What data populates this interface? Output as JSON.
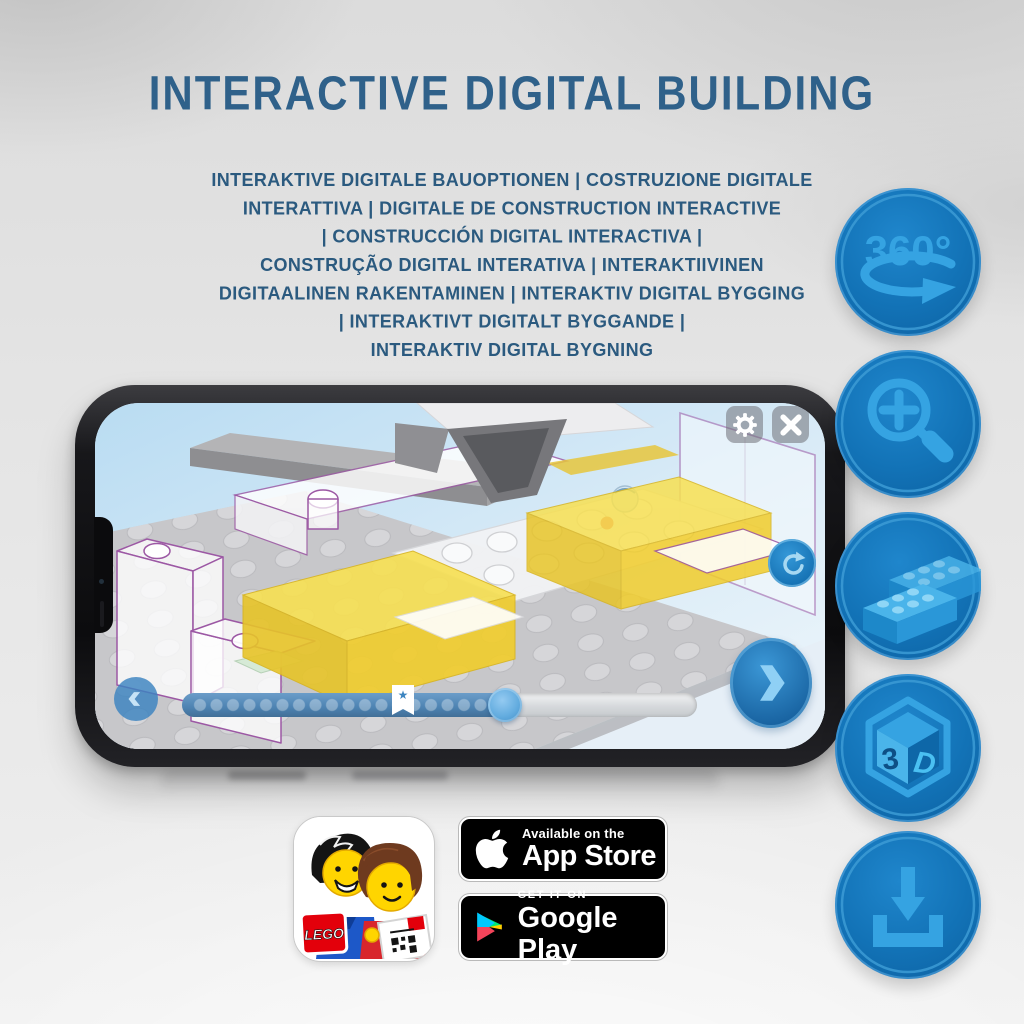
{
  "header": {
    "title": "INTERACTIVE DIGITAL BUILDING",
    "subtitle_lines": [
      "INTERAKTIVE DIGITALE BAUOPTIONEN | COSTRUZIONE DIGITALE",
      "INTERATTIVA | DIGITALE DE CONSTRUCTION INTERACTIVE",
      "| CONSTRUCCIÓN DIGITAL INTERACTIVA |",
      "CONSTRUÇÃO DIGITAL INTERATIVA | INTERAKTIIVINEN",
      "DIGITAALINEN RAKENTAMINEN | INTERAKTIV DIGITAL BYGGING",
      "| INTERAKTIVT DIGITALT BYGGANDE |",
      "INTERAKTIV DIGITAL BYGNING"
    ]
  },
  "feature_icons": {
    "rot360": {
      "name": "360-degree-icon",
      "label": "360°"
    },
    "zoom": {
      "name": "zoom-in-icon"
    },
    "bricks": {
      "name": "lego-bricks-icon"
    },
    "cube": {
      "name": "3d-cube-icon",
      "left": "3",
      "right": "D"
    },
    "download": {
      "name": "download-icon"
    }
  },
  "phone": {
    "app": {
      "settings": "gear-button",
      "close": "close-button",
      "rotate": "rotate-model-button",
      "next": "next-step-button",
      "back": "previous-step-button"
    },
    "slider": {
      "marker_glyph": "★"
    }
  },
  "store": {
    "app_icon": {
      "lego_label": "LEGO"
    },
    "app_store": {
      "line1": "Available on the",
      "line2": "App Store"
    },
    "google_play": {
      "line1": "GET IT ON",
      "line2": "Google Play"
    }
  },
  "colors": {
    "title_blue": "#2f618a",
    "circle_blue": "#1272b6",
    "glyph_blue": "#35a3e2",
    "bar_blue": "#5289b8",
    "lego_yellow": "#f2cf2c",
    "purple_outline": "#9c58a4",
    "badge_black": "#000000"
  }
}
